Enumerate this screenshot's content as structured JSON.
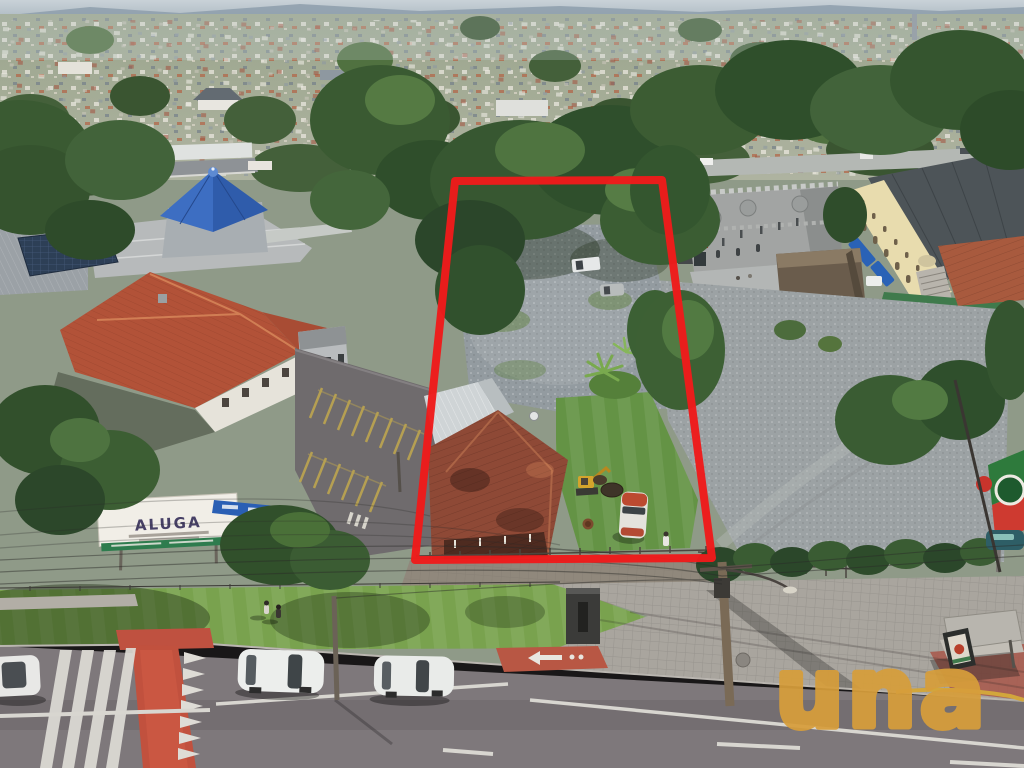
{
  "watermark": {
    "text": "una",
    "color": "#D79E3B",
    "opacity": 0.93
  },
  "property_outline": {
    "color": "#EE1B1B",
    "stroke_width": 8,
    "points": "455,181 662,180 712,558 415,560"
  },
  "signs": {
    "aluga": {
      "text": "ALUGA",
      "text_color": "#474066",
      "board_color": "#F1EEE7",
      "strip_color": "#2E7C4E"
    },
    "roadside_banner_color": "#2A5FB4",
    "restaurant_sign": {
      "board_green": "#2E7A3C",
      "board_red": "#CE3A30",
      "emblem_ring": "#EDEAE2"
    }
  }
}
